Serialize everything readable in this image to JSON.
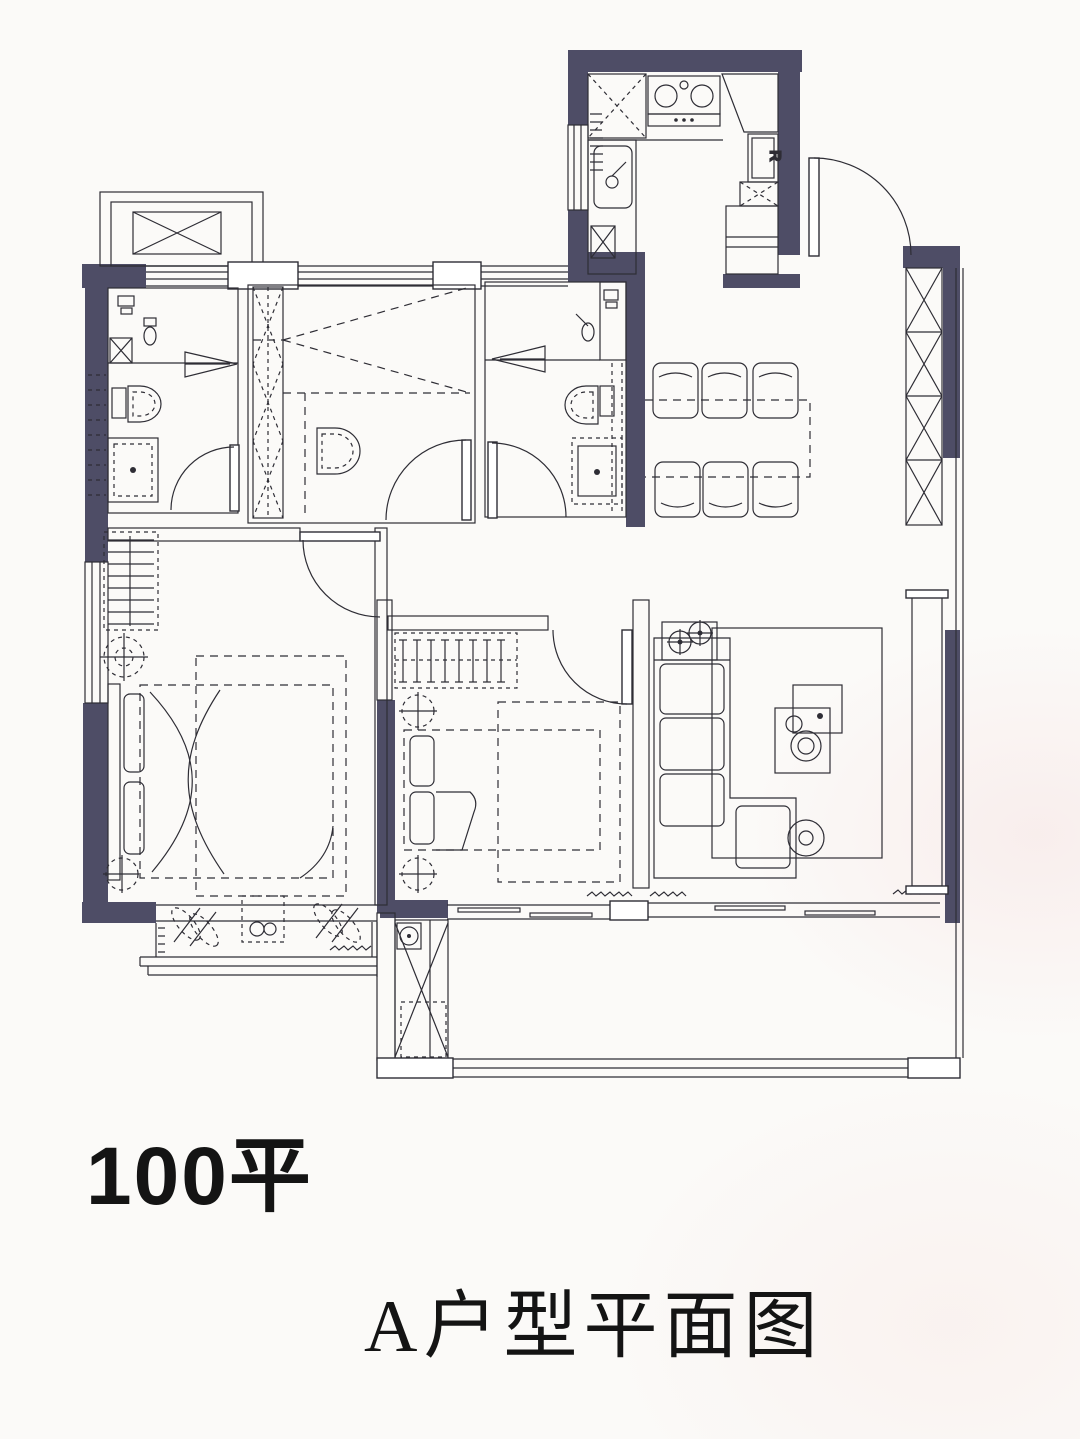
{
  "page": {
    "background": "#fbfaf8"
  },
  "plan": {
    "area_label": "100平",
    "title": "A户型平面图",
    "fridge_label": "R",
    "colors": {
      "wall": "#4e4d66",
      "line": "#2e2d35",
      "paper": "#fbfaf8"
    }
  }
}
